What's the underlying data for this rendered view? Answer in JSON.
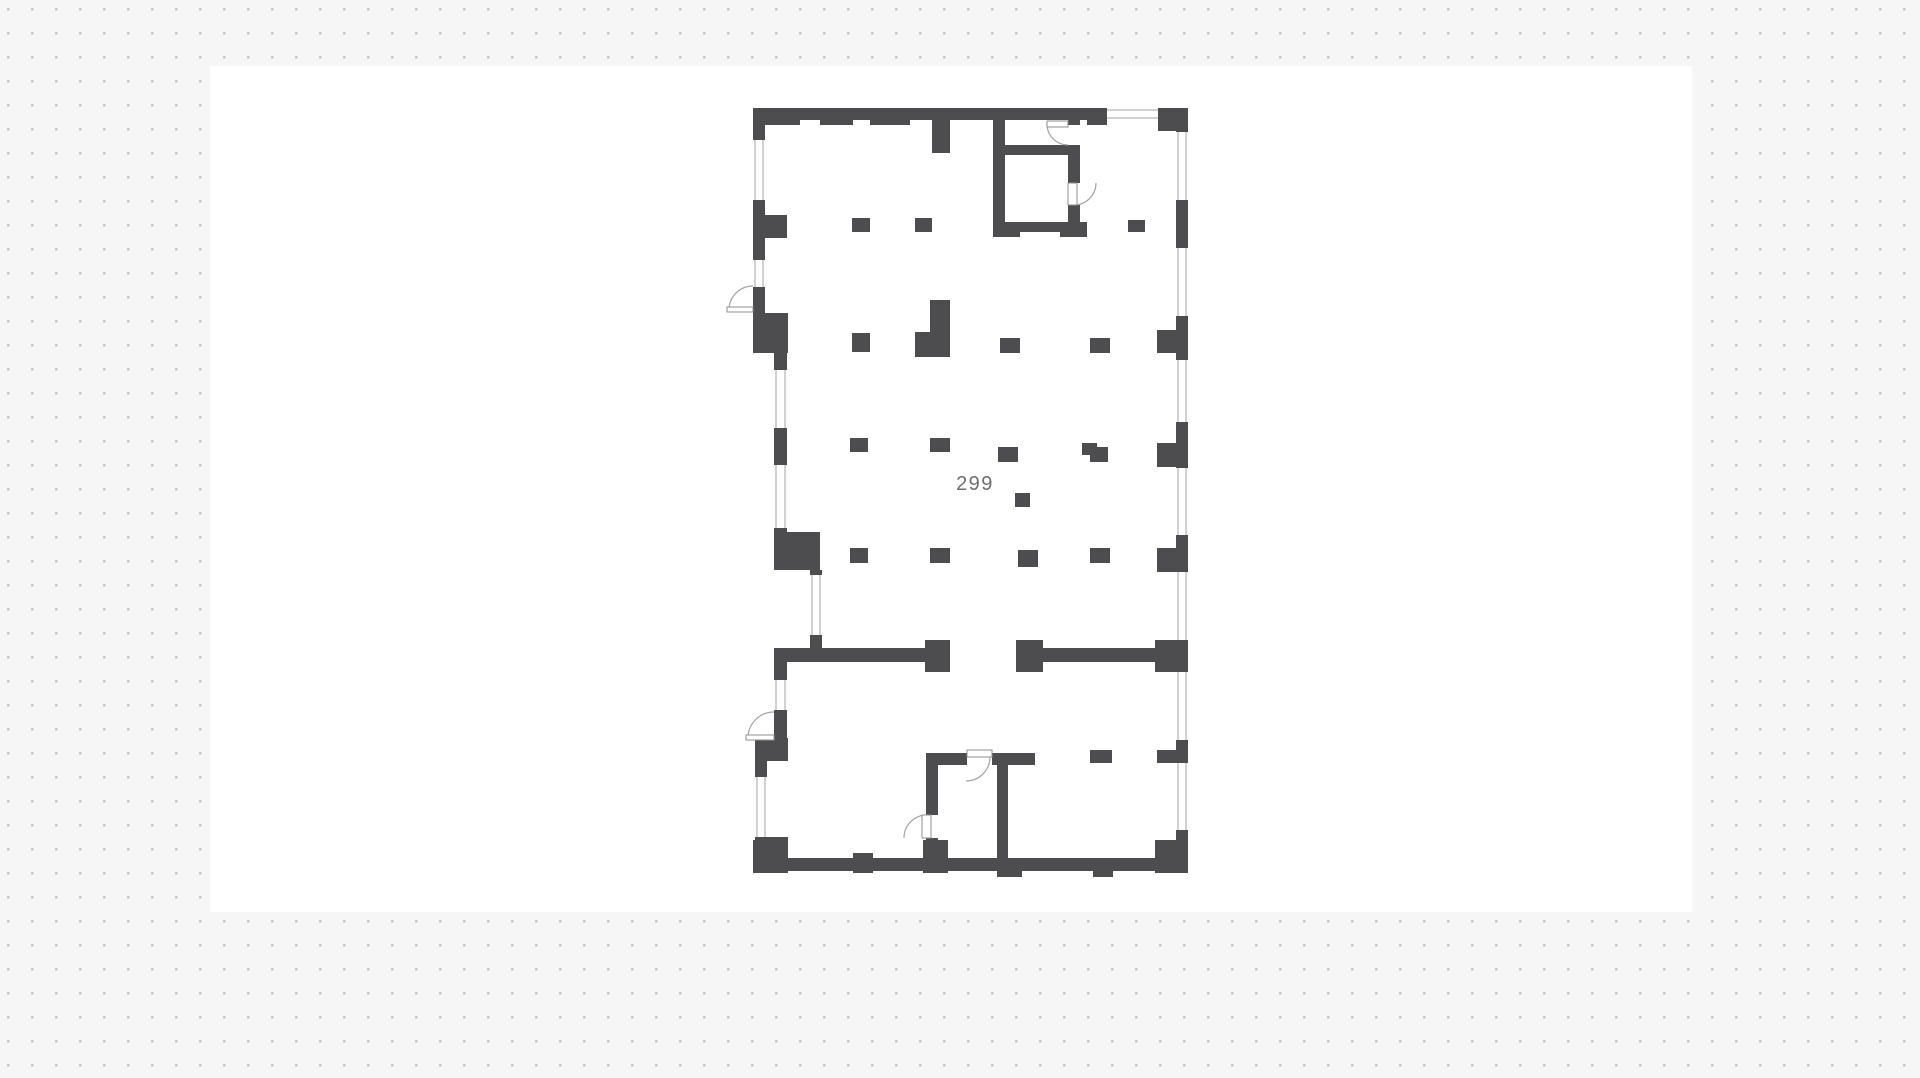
{
  "canvas": {
    "background_color": "#f6f6f6",
    "dot_color": "#c7c7c7",
    "dot_spacing_px": 24,
    "page_color": "#ffffff"
  },
  "floor_plan": {
    "room_label": "299",
    "wall_color": "#4d4d4f",
    "interior_color": "#ffffff",
    "opening_line_color": "#a3a3a3",
    "label_color": "#6f6f6f"
  }
}
